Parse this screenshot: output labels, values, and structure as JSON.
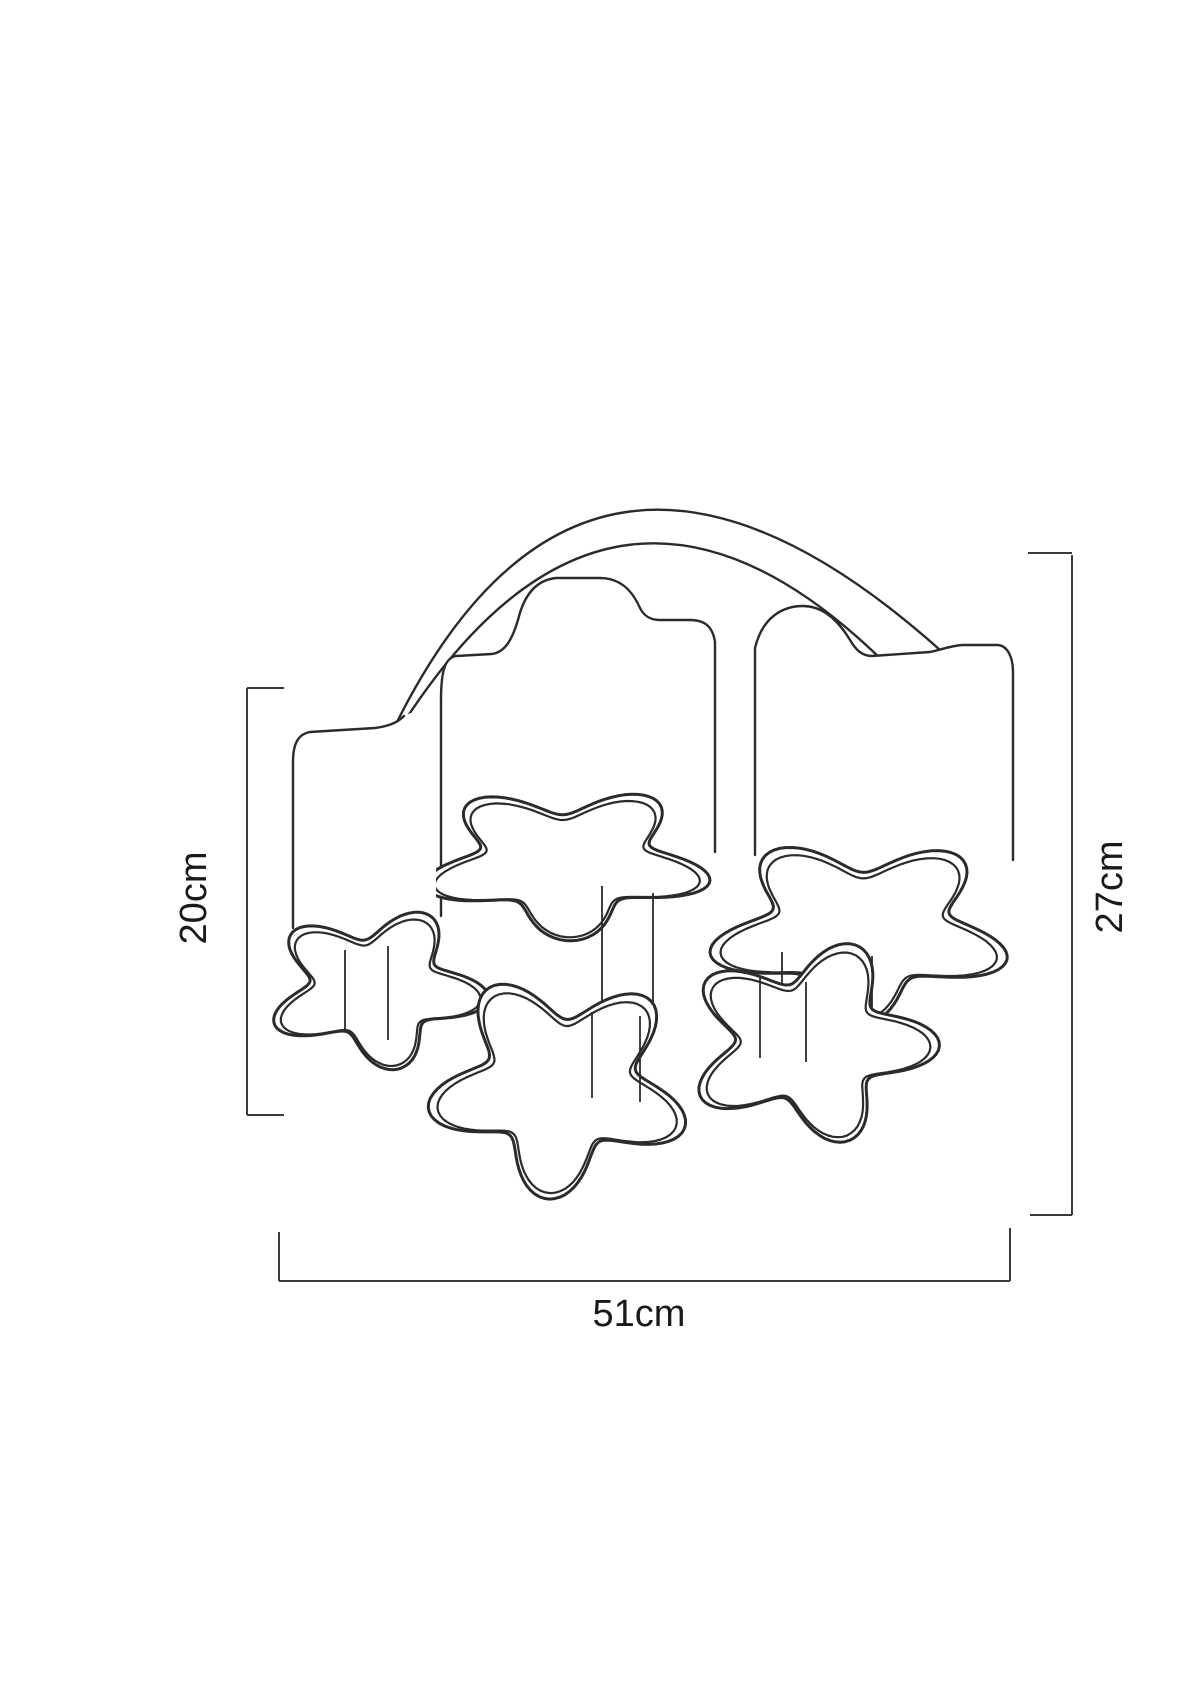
{
  "diagram": {
    "kind": "product dimension line drawing",
    "dimensions": {
      "shade_height": {
        "label": "20cm",
        "side": "left"
      },
      "total_height": {
        "label": "27cm",
        "side": "right"
      },
      "total_width": {
        "label": "51cm",
        "side": "bottom"
      }
    },
    "colors": {
      "background": "#ffffff",
      "line": "#2f2a2a",
      "dimension_line": "#3a3a3a",
      "text": "#1a1a1a"
    }
  }
}
